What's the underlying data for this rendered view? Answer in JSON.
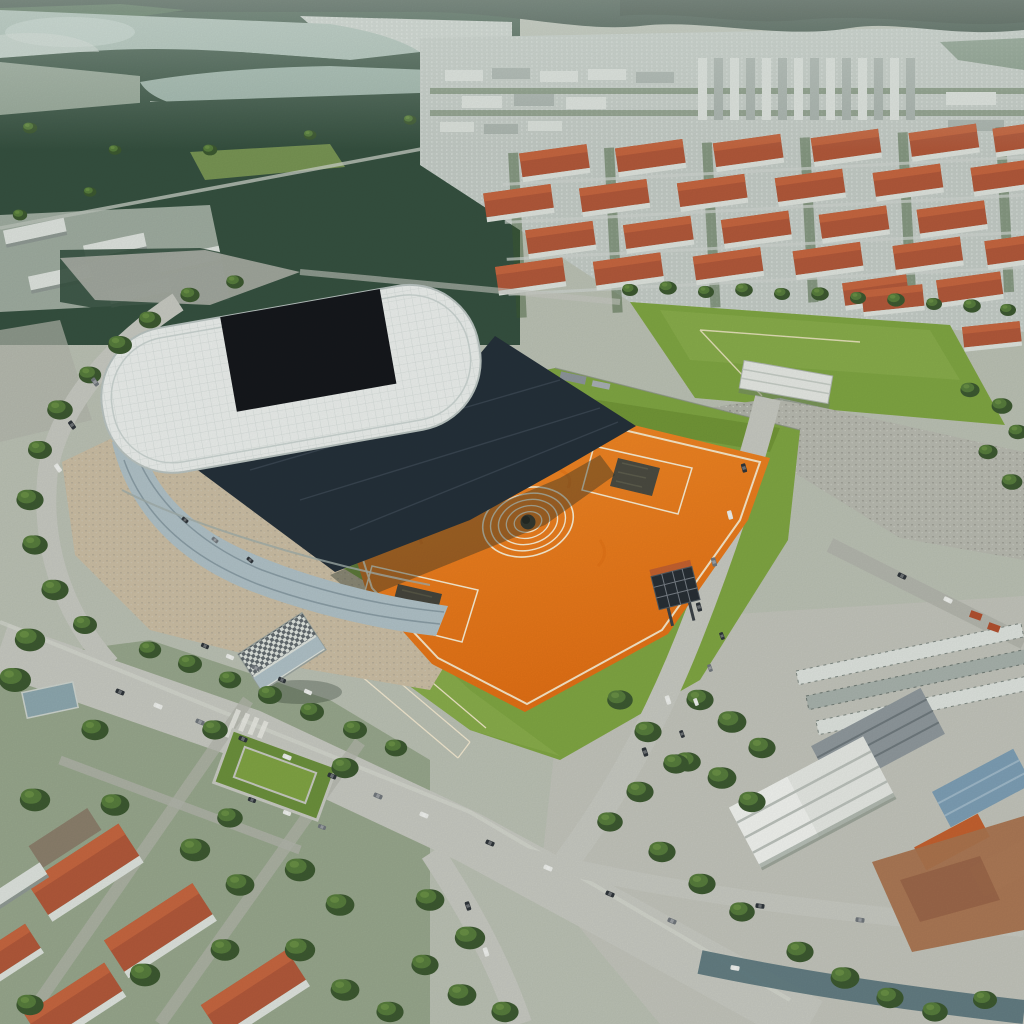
{
  "image": {
    "title": "Aerial view of a stadium complex with an orange training field",
    "description": "Aerial drone photograph: a modern arena with a white oval roof and black roof opening stands beside a large orange artificial-turf field marked with cream white lines, concentric center circles and two dark corner pads. Bright green training pitches and tree-lined boulevards with traffic surround the complex; red-roofed apartment blocks and a dense high-rise skyline fill the upper right, pine forest and two lakes stretch across the upper left, red-roofed houses sit lower left and industrial warehouses with white, blue and orange roofs occupy the lower right.",
    "type": "aerial-photograph",
    "scene_elements": [
      "mountain-ridge",
      "upper-lake",
      "lower-lake",
      "pine-forest-belt",
      "high-rise-skyline",
      "red-roof-apartment-district",
      "stadium-white-roof",
      "stadium-roof-opening",
      "stadium-stands",
      "orange-turf-field",
      "center-circles",
      "corner-pads",
      "scoreboard",
      "training-pitch",
      "training-hall",
      "boulevard-with-cars",
      "small-grandstand",
      "pond",
      "park-square",
      "red-roof-houses",
      "industrial-warehouses",
      "tree-clusters"
    ]
  },
  "orange_field": {
    "surface": "orange artificial turf",
    "center_circle_rings": 5,
    "corner_pads": 2,
    "line_color_name": "cream white",
    "has_scoreboard": true
  },
  "stadium": {
    "roof_color_name": "white",
    "roof_opening_color_name": "black",
    "stands_color_name": "dark navy",
    "facade": "glass band"
  },
  "palette": {
    "mountain": "#2E4337",
    "mountain2": "#24362C",
    "forestDark": "#35503F",
    "forestMid": "#4A6A4C",
    "treeDark": "#3C5830",
    "treeMid": "#567B3C",
    "treeLight": "#6C9246",
    "waterLight": "#C6D5CE",
    "water": "#A9BEB4",
    "water2": "#9CB3A8",
    "marsh": "#93A494",
    "hazeCity": "#C9D1CB",
    "cityBase": "#C2CAC4",
    "slabLight": "#DCE1DC",
    "slabMid": "#A6B0AA",
    "roofRed": "#B0583A",
    "roofRedLight": "#C4653F",
    "facadeWhite": "#DCE1DB",
    "grass": "#7EA442",
    "grassL": "#90B251",
    "grassD": "#66882F",
    "road": "#C5C7BF",
    "roadMid": "#B0B3AA",
    "roadTeal": "#5A757C",
    "dirt": "#C9BCA2",
    "gravel": "#B6B8AE",
    "stadiumRoof": "#E9EDEA",
    "stadiumBlack": "#15181C",
    "stands": "#243039",
    "glass": "#AEBFC5",
    "orange": "#E8771C",
    "orangeDeep": "#D96A12",
    "lineWhite": "#F6EAD0",
    "boardDark": "#272E34",
    "pond": "#8CA6AD",
    "whWhite": "#E3E6E1",
    "whGray": "#8E979B",
    "whBlue": "#7C9DB3",
    "whOrange": "#C2602F",
    "dirtBrown": "#A8734E",
    "brown": "#8A7E6B",
    "carDark": "#2F353A",
    "carLight": "#E9EBE7",
    "carMid": "#70767B"
  }
}
